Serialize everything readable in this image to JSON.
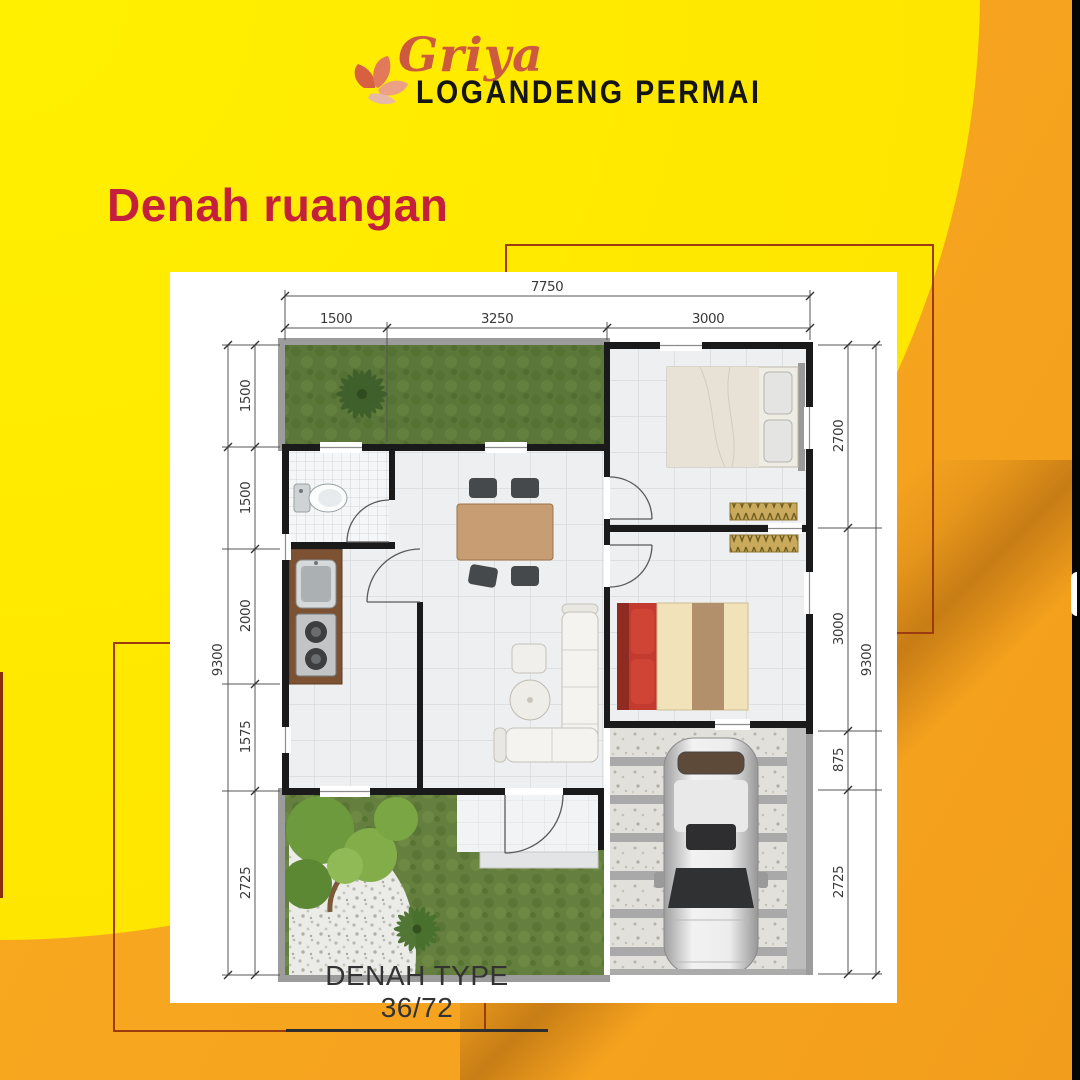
{
  "brand": {
    "script_name": "Griya",
    "name": "LOGANDENG PERMAI"
  },
  "heading": {
    "title": "Denah ruangan"
  },
  "plan": {
    "caption": "DENAH TYPE 36/72",
    "dims": {
      "top_total": "7750",
      "top_segments": [
        "1500",
        "3250",
        "3000"
      ],
      "left_total": "9300",
      "left_segments": [
        "1500",
        "1500",
        "2000",
        "1575",
        "2725"
      ],
      "right_segments": [
        "2700",
        "3000",
        "875",
        "2725"
      ],
      "right_total": "9300"
    },
    "features": [
      "front-garden",
      "bathroom",
      "kitchen",
      "dining-table",
      "living-sofa",
      "bedroom-1-bed",
      "bedroom-2-bed",
      "carport-car",
      "palm-tree",
      "rear-garden"
    ]
  },
  "colors": {
    "yellow": "#ffe400",
    "orange": "#f6a41f",
    "heading_red": "#c41f3c",
    "accent_line": "#9c3a10",
    "brand_script": "#cd5a3e",
    "text_dark": "#333333"
  }
}
